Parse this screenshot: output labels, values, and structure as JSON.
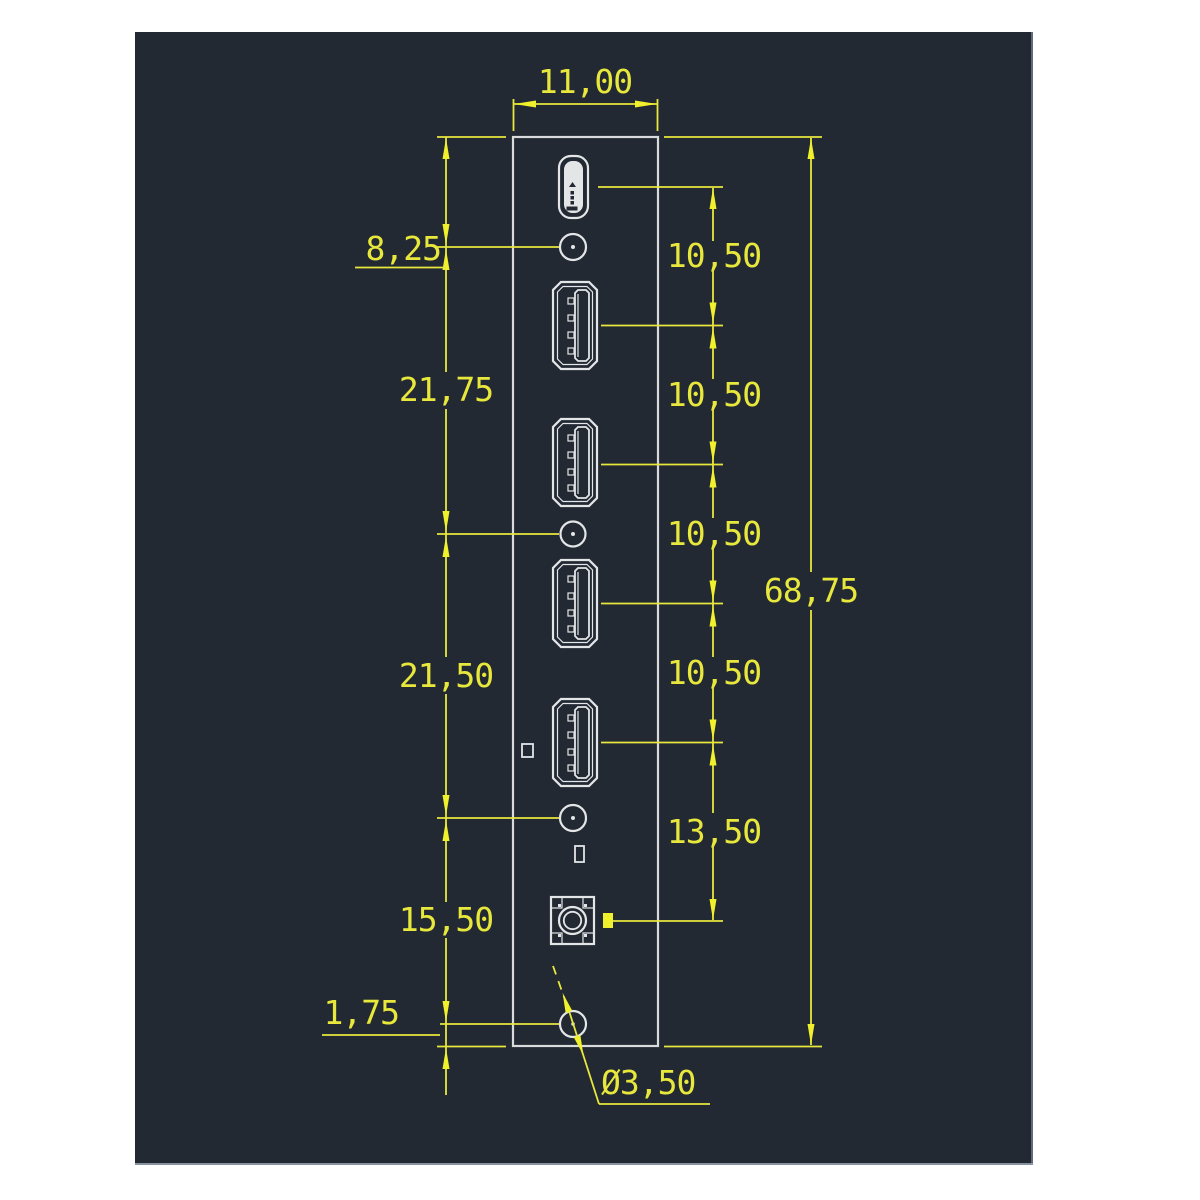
{
  "drawing": {
    "type": "CAD front-panel dimension drawing",
    "colors": {
      "page_bg": "#ffffff",
      "canvas_bg": "#222933",
      "dimension_color": "#e7e73c",
      "outline_color": "#e3e5e7"
    },
    "dimensions": {
      "top_width": "11,00",
      "overall_height": "68,75",
      "left_chain": [
        "8,25",
        "21,75",
        "21,50",
        "15,50",
        "1,75"
      ],
      "right_chain": [
        "10,50",
        "10,50",
        "10,50",
        "10,50",
        "13,50"
      ],
      "hole_diameter": "Ø3,50"
    }
  }
}
